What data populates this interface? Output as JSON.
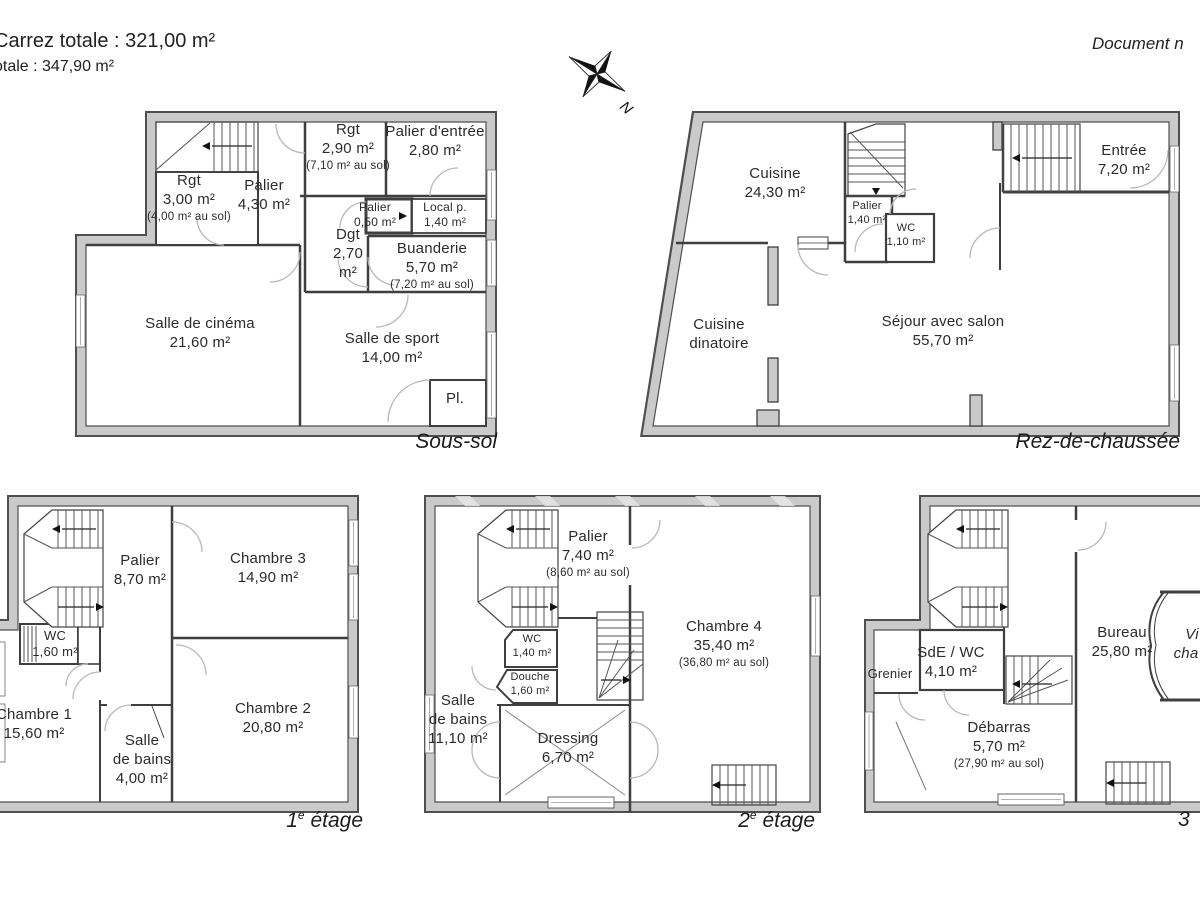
{
  "header": {
    "carrez_total": "Carrez totale :  321,00 m²",
    "total": "otale :  347,90 m²",
    "document_note": "Document n"
  },
  "compass": {
    "north_label": "N"
  },
  "colors": {
    "wall_fill": "#cacaca",
    "wall_outline": "#4f4f4f",
    "text": "#2b2b2b"
  },
  "floors": [
    {
      "label": "Sous-sol",
      "rooms": [
        {
          "name": "Rgt",
          "area": "3,00 m²",
          "floor_area": "(4,00 m² au sol)"
        },
        {
          "name": "Palier",
          "area": "4,30 m²"
        },
        {
          "name": "Rgt",
          "area": "2,90 m²",
          "floor_area": "(7,10 m² au sol)"
        },
        {
          "name": "Palier d'entrée",
          "area": "2,80 m²"
        },
        {
          "name": "Palier",
          "area": "0,50 m²"
        },
        {
          "name": "Local p.",
          "area": "1,40 m²"
        },
        {
          "name": "Dgt",
          "area": "2,70 m²"
        },
        {
          "name": "Buanderie",
          "area": "5,70 m²",
          "floor_area": "(7,20 m² au sol)"
        },
        {
          "name": "Salle de cinéma",
          "area": "21,60 m²"
        },
        {
          "name": "Salle de sport",
          "area": "14,00 m²"
        },
        {
          "name": "Pl."
        }
      ]
    },
    {
      "label": "Rez-de-chaussée",
      "rooms": [
        {
          "name": "Cuisine",
          "area": "24,30 m²"
        },
        {
          "name": "Palier",
          "area": "1,40 m²"
        },
        {
          "name": "WC",
          "area": "1,10 m²"
        },
        {
          "name": "Entrée",
          "area": "7,20 m²"
        },
        {
          "name": "Séjour avec salon",
          "area": "55,70 m²"
        },
        {
          "name": "Cuisine",
          "name2": "dinatoire"
        }
      ]
    },
    {
      "label_num": "1",
      "label_sup": "e",
      "label_rest": " étage",
      "rooms": [
        {
          "name": "Palier",
          "area": "8,70 m²"
        },
        {
          "name": "Chambre 3",
          "area": "14,90 m²"
        },
        {
          "name": "WC",
          "area": "1,60 m²"
        },
        {
          "name": "Chambre 1",
          "area": "15,60 m²"
        },
        {
          "name": "Salle",
          "name2": "de bains",
          "area": "4,00 m²"
        },
        {
          "name": "Chambre 2",
          "area": "20,80 m²"
        }
      ]
    },
    {
      "label_num": "2",
      "label_sup": "e",
      "label_rest": " étage",
      "rooms": [
        {
          "name": "Palier",
          "area": "7,40 m²",
          "floor_area": "(8,60 m² au sol)"
        },
        {
          "name": "WC",
          "area": "1,40 m²"
        },
        {
          "name": "Douche",
          "area": "1,60 m²"
        },
        {
          "name": "Salle",
          "name2": "de bains",
          "area": "11,10 m²"
        },
        {
          "name": "Dressing",
          "area": "6,70 m²"
        },
        {
          "name": "Chambre 4",
          "area": "35,40 m²",
          "floor_area": "(36,80 m² au sol)"
        }
      ]
    },
    {
      "label": "3",
      "rooms": [
        {
          "name": "Grenier"
        },
        {
          "name": "SdE / WC",
          "area": "4,10 m²"
        },
        {
          "name": "Débarras",
          "area": "5,70 m²",
          "floor_area": "(27,90 m² au sol)"
        },
        {
          "name": "Bureau",
          "area": "25,80 m²"
        },
        {
          "line1": "Vi",
          "line2": "cha"
        }
      ]
    }
  ]
}
